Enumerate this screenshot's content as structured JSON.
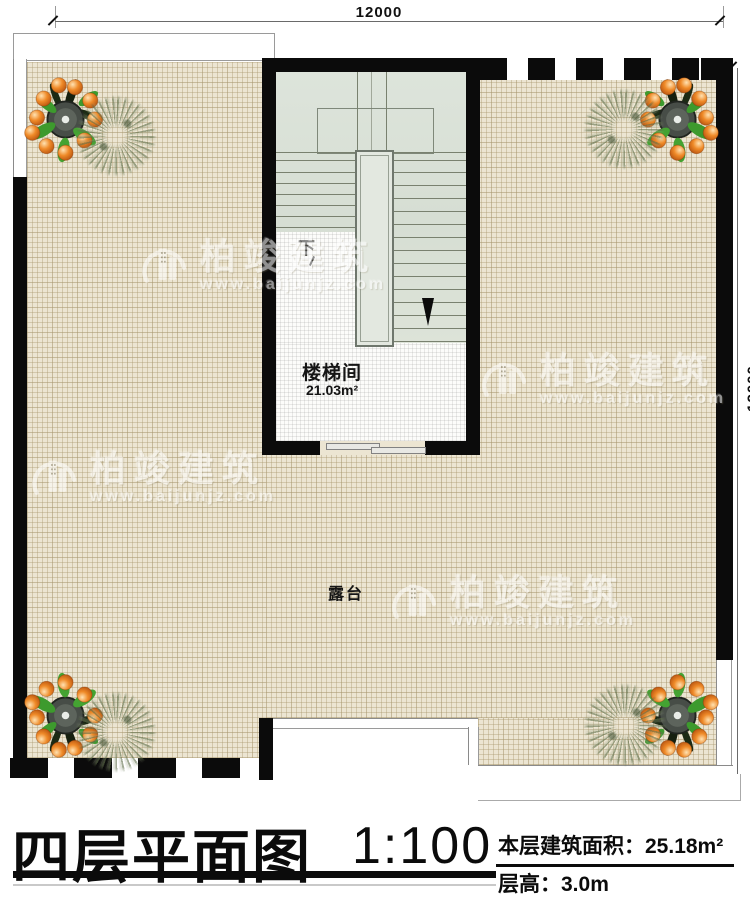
{
  "dimensions": {
    "top": "12000",
    "right": "12000"
  },
  "stairwell": {
    "label": "楼梯间",
    "area": "21.03m²",
    "down_label": "下"
  },
  "terrace": {
    "label": "露台"
  },
  "watermark": {
    "brand": "柏竣建筑",
    "url": "www.baijunjz.com"
  },
  "title_block": {
    "title": "四层平面图",
    "scale": "1:100",
    "area_label": "本层建筑面积：",
    "area_value": "25.18m²",
    "height_label": "层高：",
    "height_value": "3.0m"
  },
  "colors": {
    "wall": "#0b0b0b",
    "terrace_bg": "#ece5d2",
    "stair_bg": "#dde4da",
    "fruit_orange": "#e8731f",
    "leaf_green": "#3d9a2d"
  }
}
